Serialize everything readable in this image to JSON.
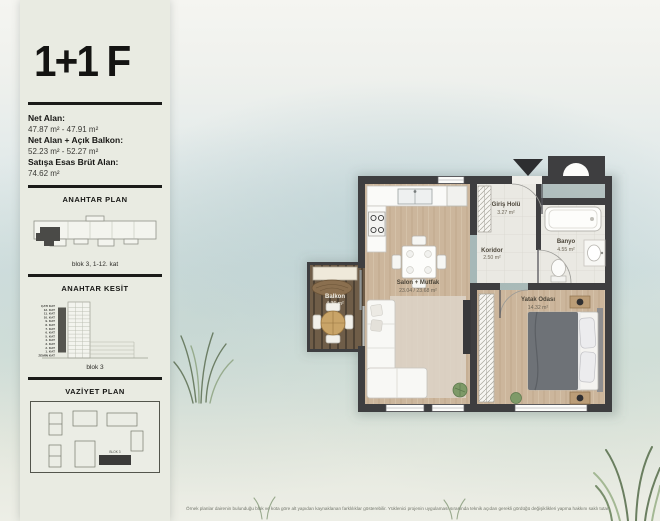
{
  "page": {
    "disclaimer": "Örnek planlar dairenin bulunduğu blok ve kota göre alt yapıdan kaynaklanan farklılıklar gösterebilir. Yüklenici projenin uygulaması sırasında teknik açıdan gerekli gördüğü değişiklikleri yapma hakkını saklı tutar."
  },
  "sidebar": {
    "title": "1+1 F",
    "areas": [
      {
        "label": "Net Alan:",
        "value": "47.87 m² - 47.91 m²"
      },
      {
        "label": "Net Alan + Açık Balkon:",
        "value": "52.23 m² - 52.27 m²"
      },
      {
        "label": "Satışa Esas Brüt Alan:",
        "value": "74.62 m²"
      }
    ],
    "anahtar_plan": {
      "heading": "ANAHTAR PLAN",
      "caption": "blok 3, 1-12. kat"
    },
    "anahtar_kesit": {
      "heading": "ANAHTAR KESİT",
      "caption": "blok 3",
      "floors": [
        "ÇATI KAT",
        "12. KAT",
        "11. KAT",
        "10. KAT",
        "9. KAT",
        "8. KAT",
        "7. KAT",
        "6. KAT",
        "5. KAT",
        "4. KAT",
        "3. KAT",
        "2. KAT",
        "1. KAT",
        "ZEMİN KAT"
      ]
    },
    "vaziyet_plan": {
      "heading": "VAZİYET PLAN",
      "highlighted_block": "BLOK 3"
    }
  },
  "floorplan": {
    "rooms": [
      {
        "name": "Salon + Mutfak",
        "area": "23.04 / 23.68 m²"
      },
      {
        "name": "Yatak Odası",
        "area": "14.32 m²"
      },
      {
        "name": "Banyo",
        "area": "4.55 m²"
      },
      {
        "name": "Koridor",
        "area": "2.50 m²"
      },
      {
        "name": "Giriş Holü",
        "area": "3.27 m²"
      },
      {
        "name": "Balkon",
        "area": "4.36 m²"
      }
    ]
  },
  "colors": {
    "wall": "#3e3e40",
    "wood_floor": "#ccb69c",
    "balcony_deck": "#6f5d48",
    "tile_floor": "#eae9e3",
    "sidebar_bg": "#e9ebe2",
    "highlight_dark": "#3c3c3a",
    "text": "#1c1c1a"
  }
}
